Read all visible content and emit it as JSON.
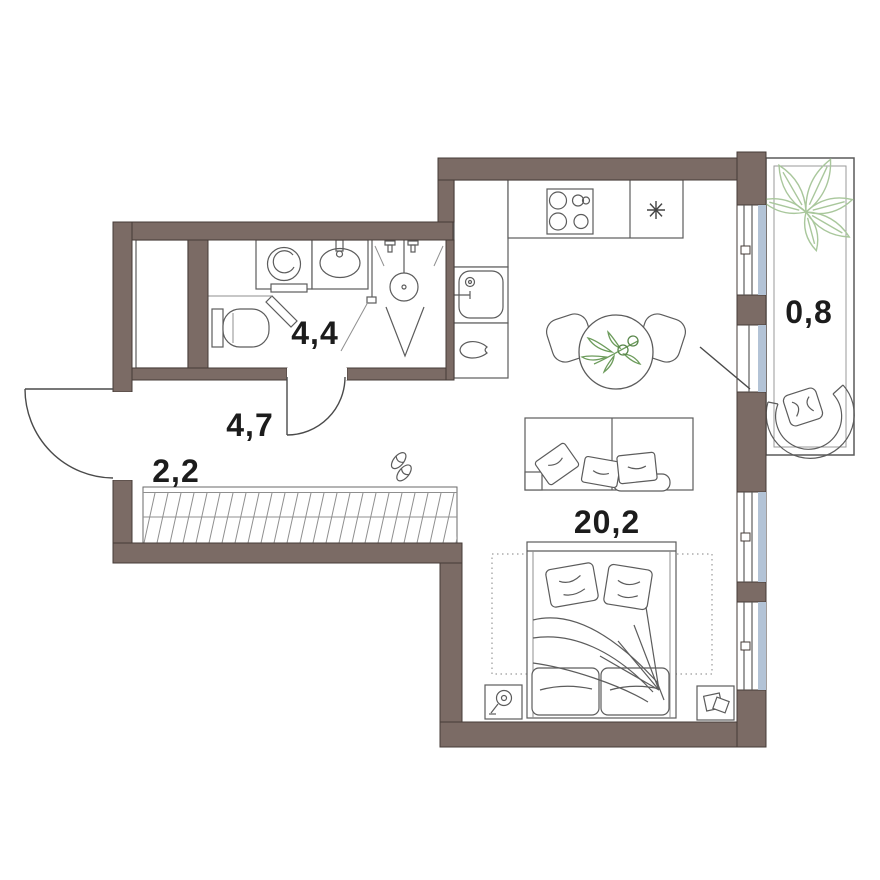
{
  "plan": {
    "rooms": [
      {
        "name": "bathroom",
        "area_label": "4,4"
      },
      {
        "name": "hallway",
        "area_label": "4,7"
      },
      {
        "name": "wardrobe",
        "area_label": "2,2"
      },
      {
        "name": "living-room-with-kitchen",
        "area_label": "20,2"
      },
      {
        "name": "balcony",
        "area_label": "0,8"
      }
    ],
    "fixtures": [
      "toilet",
      "washing-machine",
      "bathroom-sink",
      "shower",
      "towel-bar",
      "kitchen-sink",
      "stove",
      "fridge",
      "water-drop",
      "dining-table",
      "dining-chairs",
      "plant-sprig",
      "sofa",
      "pillows",
      "double-bed",
      "nightstand",
      "table-lamp",
      "papers",
      "slippers",
      "wardrobe-rail",
      "balcony-plant",
      "armchair",
      "entrance-door",
      "bathroom-door",
      "balcony-door",
      "window"
    ],
    "colors": {
      "background": "#ffffff",
      "wall_fill": "#7b6b65",
      "wall_stroke": "#463b37",
      "furniture_line": "#5c5c5c",
      "light_line": "#8f8f8f",
      "glass": "#b3c3d6",
      "plant_light": "#a9c79c",
      "plant_dark": "#6d9c5c",
      "label_text": "#1c1c1c"
    }
  }
}
